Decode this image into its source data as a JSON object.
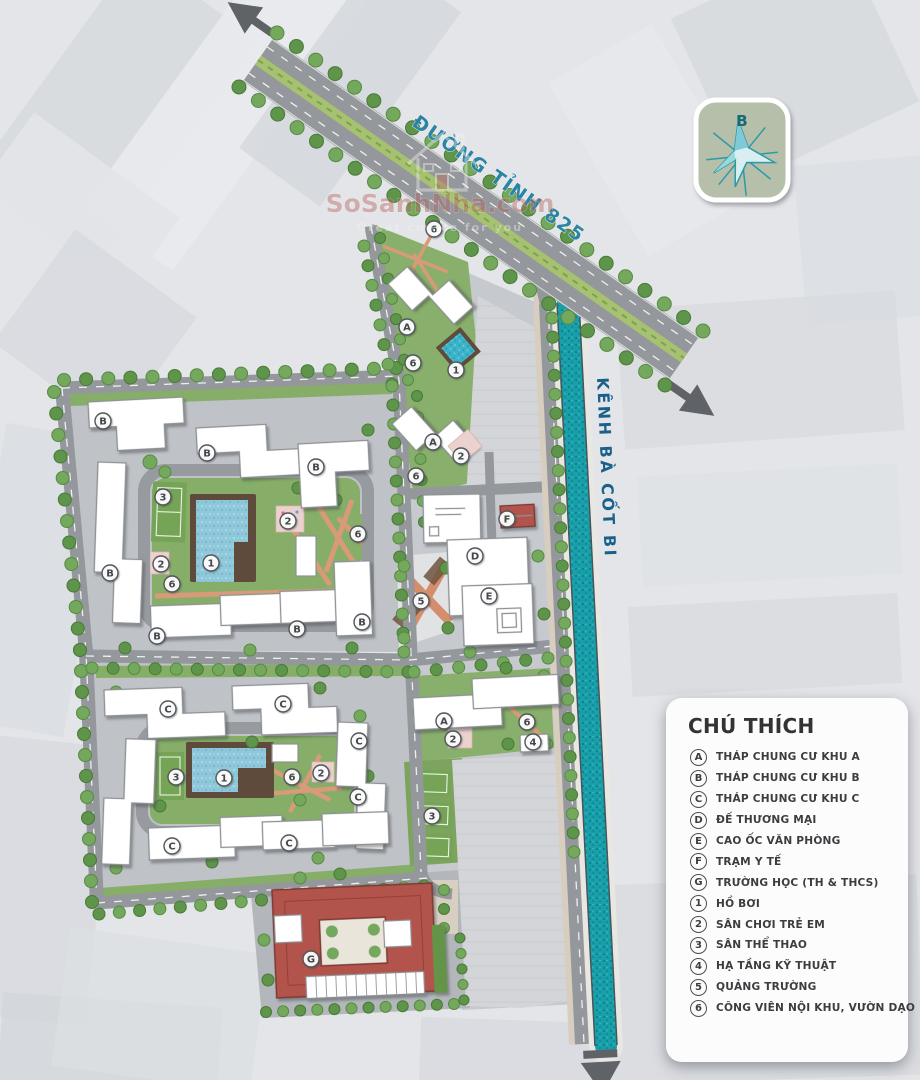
{
  "map": {
    "road_label": "ĐƯỜNG TỈNH 825",
    "canal_label": "KÊNH BÀ CỐT BI",
    "compass": {
      "north_label": "B"
    },
    "watermark": {
      "brand": "SoSanhNha.com",
      "tagline": "Great choice for you"
    },
    "markers": [
      {
        "label": "6",
        "x": 434,
        "y": 229
      },
      {
        "label": "A",
        "x": 407,
        "y": 327
      },
      {
        "label": "6",
        "x": 413,
        "y": 363
      },
      {
        "label": "1",
        "x": 456,
        "y": 370
      },
      {
        "label": "A",
        "x": 433,
        "y": 442
      },
      {
        "label": "2",
        "x": 461,
        "y": 456
      },
      {
        "label": "6",
        "x": 416,
        "y": 476
      },
      {
        "label": "B",
        "x": 103,
        "y": 421
      },
      {
        "label": "B",
        "x": 207,
        "y": 453
      },
      {
        "label": "B",
        "x": 316,
        "y": 467
      },
      {
        "label": "B",
        "x": 110,
        "y": 573
      },
      {
        "label": "B",
        "x": 157,
        "y": 636
      },
      {
        "label": "B",
        "x": 297,
        "y": 629
      },
      {
        "label": "B",
        "x": 362,
        "y": 622
      },
      {
        "label": "3",
        "x": 163,
        "y": 497
      },
      {
        "label": "2",
        "x": 288,
        "y": 521
      },
      {
        "label": "6",
        "x": 358,
        "y": 534
      },
      {
        "label": "1",
        "x": 211,
        "y": 563
      },
      {
        "label": "2",
        "x": 161,
        "y": 564
      },
      {
        "label": "6",
        "x": 172,
        "y": 584
      },
      {
        "label": "F",
        "x": 507,
        "y": 519
      },
      {
        "label": "D",
        "x": 475,
        "y": 556
      },
      {
        "label": "E",
        "x": 489,
        "y": 596
      },
      {
        "label": "5",
        "x": 421,
        "y": 601
      },
      {
        "label": "A",
        "x": 444,
        "y": 721
      },
      {
        "label": "2",
        "x": 453,
        "y": 739
      },
      {
        "label": "6",
        "x": 527,
        "y": 722
      },
      {
        "label": "4",
        "x": 533,
        "y": 742
      },
      {
        "label": "3",
        "x": 432,
        "y": 816
      },
      {
        "label": "C",
        "x": 168,
        "y": 709
      },
      {
        "label": "C",
        "x": 283,
        "y": 704
      },
      {
        "label": "C",
        "x": 359,
        "y": 741
      },
      {
        "label": "C",
        "x": 358,
        "y": 797
      },
      {
        "label": "C",
        "x": 172,
        "y": 846
      },
      {
        "label": "C",
        "x": 289,
        "y": 843
      },
      {
        "label": "3",
        "x": 176,
        "y": 777
      },
      {
        "label": "1",
        "x": 224,
        "y": 778
      },
      {
        "label": "6",
        "x": 292,
        "y": 777
      },
      {
        "label": "2",
        "x": 321,
        "y": 773
      },
      {
        "label": "G",
        "x": 311,
        "y": 959
      }
    ]
  },
  "legend": {
    "title": "CHÚ THÍCH",
    "items": [
      {
        "key": "A",
        "label": "THÁP CHUNG CƯ KHU A"
      },
      {
        "key": "B",
        "label": "THÁP CHUNG CƯ KHU B"
      },
      {
        "key": "C",
        "label": "THÁP CHUNG CƯ KHU C"
      },
      {
        "key": "D",
        "label": "ĐẾ THƯƠNG MẠI"
      },
      {
        "key": "E",
        "label": "CAO ỐC VĂN PHÒNG"
      },
      {
        "key": "F",
        "label": "TRẠM Y TẾ"
      },
      {
        "key": "G",
        "label": "TRƯỜNG HỌC (TH & THCS)"
      },
      {
        "key": "1",
        "label": "HỒ BƠI"
      },
      {
        "key": "2",
        "label": "SÂN CHƠI TRẺ EM"
      },
      {
        "key": "3",
        "label": "SÂN THỂ THAO"
      },
      {
        "key": "4",
        "label": "HẠ TẦNG KỸ THUẬT"
      },
      {
        "key": "5",
        "label": "QUẢNG TRƯỜNG"
      },
      {
        "key": "6",
        "label": "CÔNG VIÊN NỘI KHU, VƯỜN DẠO"
      }
    ]
  },
  "colors": {
    "canal": "#189fa9",
    "road": "#94979b",
    "green": "#86ae68",
    "school_roof": "#b2544b",
    "label_blue": "#2b84a4"
  }
}
